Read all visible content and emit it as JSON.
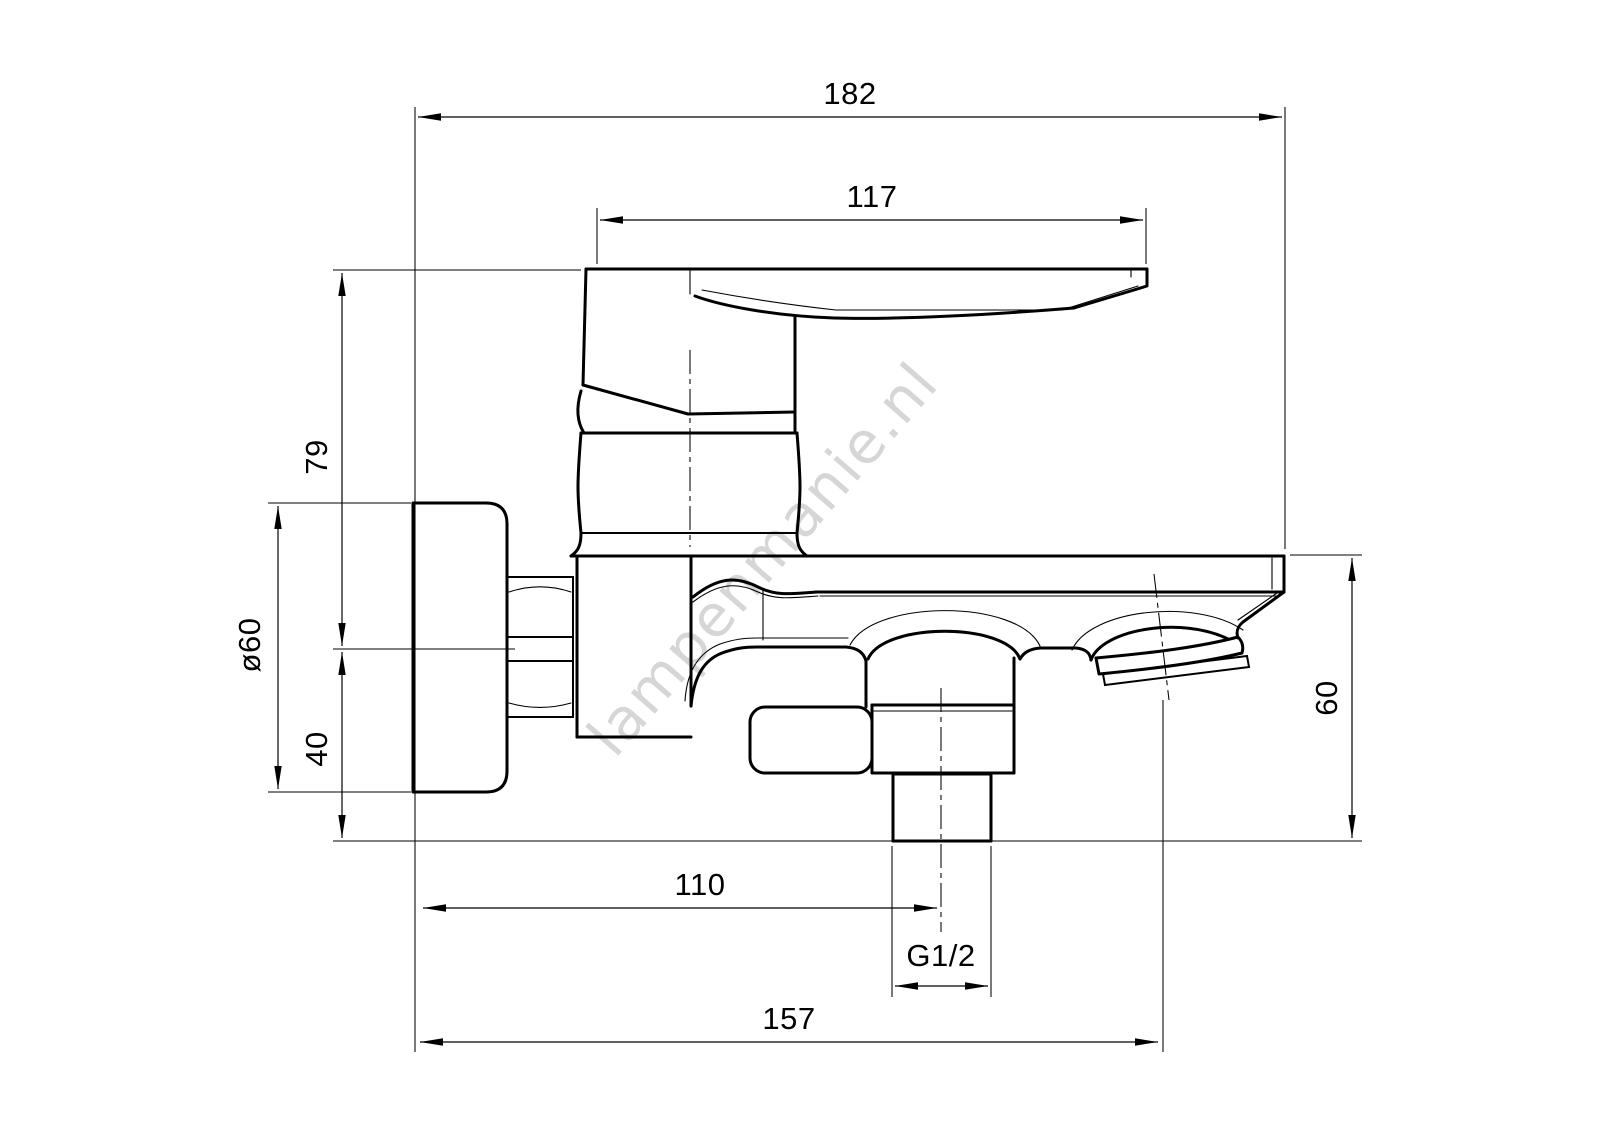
{
  "page": {
    "background": "#ffffff",
    "line_color": "#000000"
  },
  "watermark": {
    "text": "lampenmanie.nl",
    "color": "#d2d2d2"
  },
  "drawing": {
    "subject": "wall-mounted bath mixer tap, side view technical drawing",
    "dimensions": [
      {
        "id": "overall-depth",
        "label": "182",
        "orientation": "horizontal"
      },
      {
        "id": "handle-length",
        "label": "117",
        "orientation": "horizontal"
      },
      {
        "id": "handle-above-center",
        "label": "79",
        "orientation": "vertical"
      },
      {
        "id": "flange-diameter",
        "label": "ø60",
        "orientation": "vertical"
      },
      {
        "id": "center-to-bottom",
        "label": "40",
        "orientation": "vertical"
      },
      {
        "id": "spout-height",
        "label": "60",
        "orientation": "vertical"
      },
      {
        "id": "wall-to-outlet",
        "label": "110",
        "orientation": "horizontal"
      },
      {
        "id": "thread-size",
        "label": "G1/2",
        "orientation": "horizontal"
      },
      {
        "id": "wall-to-spout-tip",
        "label": "157",
        "orientation": "horizontal"
      }
    ]
  }
}
